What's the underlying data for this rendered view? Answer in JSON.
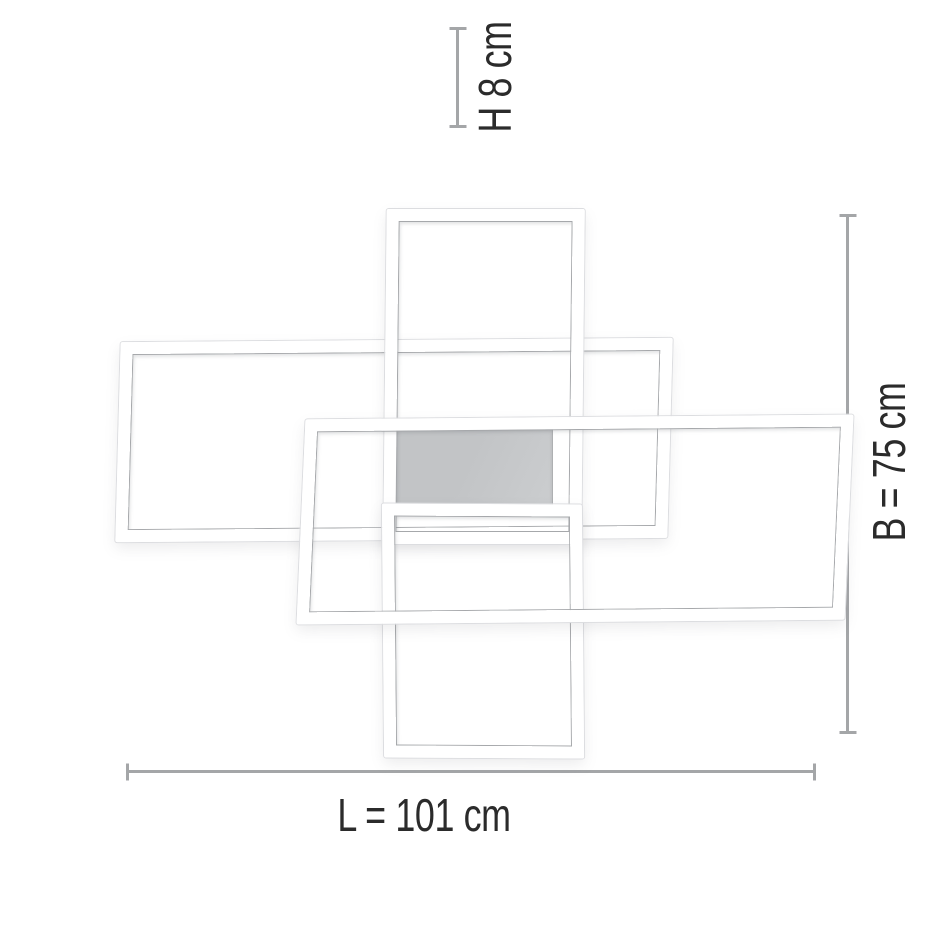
{
  "figure": {
    "type": "product-dimension-diagram",
    "unit": "cm"
  },
  "dimensions": {
    "height": {
      "label": "H 8 cm",
      "letter": "H",
      "value": 8
    },
    "width": {
      "label": "B = 75 cm",
      "letter": "B",
      "value": 75
    },
    "length": {
      "label": "L = 101 cm",
      "letter": "L",
      "value": 101
    }
  },
  "colors": {
    "background": "#ffffff",
    "dim-line": "#a4a6a8",
    "label-text": "#2b2b2b",
    "frame-fill": "#ffffff",
    "frame-inner-line": "#a6a8ab",
    "frame-outer-line": "#dcdde0",
    "panel-top": "#c2c4c6",
    "panel-bottom": "#cbcdcf",
    "panel-border": "#aeb0b2"
  }
}
